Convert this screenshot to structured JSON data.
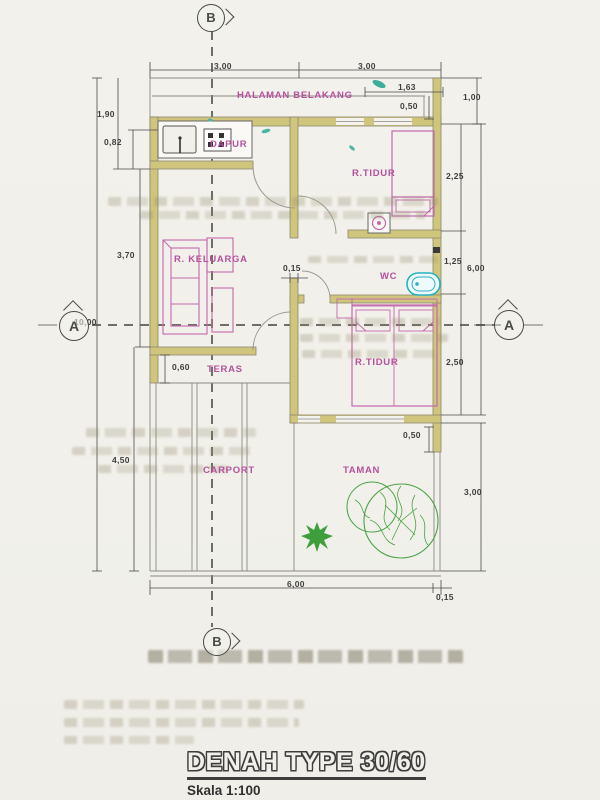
{
  "title": {
    "main": "DENAH TYPE 30/60",
    "scale": "Skala 1:100"
  },
  "labels": {
    "halaman_belakang": "HALAMAN BELAKANG",
    "dapur": "DAPUR",
    "r_tidur_1": "R.TIDUR",
    "r_keluarga": "R. KELUARGA",
    "wc": "WC",
    "r_tidur_2": "R.TIDUR",
    "teras": "TERAS",
    "carport": "CARPORT",
    "taman": "TAMAN"
  },
  "markers": {
    "top": "B",
    "bottom": "B",
    "left": "A",
    "right": "A"
  },
  "dims": {
    "top_1": "3,00",
    "top_2": "3,00",
    "r_163": "1,63",
    "r_050a": "0,50",
    "r_100": "1,00",
    "r_225": "2,25",
    "r_125": "1,25",
    "r_600": "6,00",
    "r_250": "2,50",
    "r_050b": "0,50",
    "r_300": "3,00",
    "r_015": "0,15",
    "l_190": "1,90",
    "l_082": "0,82",
    "l_370": "3,70",
    "l_1000": "10,00",
    "l_450": "4,50",
    "b_600": "6,00",
    "i_015": "0,15",
    "i_060": "0,60"
  },
  "colors": {
    "wall": "#d0c57c",
    "room_label": "#b5519d",
    "fixture_cyan": "#29afc3",
    "plant_green": "#49a344",
    "line_gray": "#8a8a82"
  }
}
